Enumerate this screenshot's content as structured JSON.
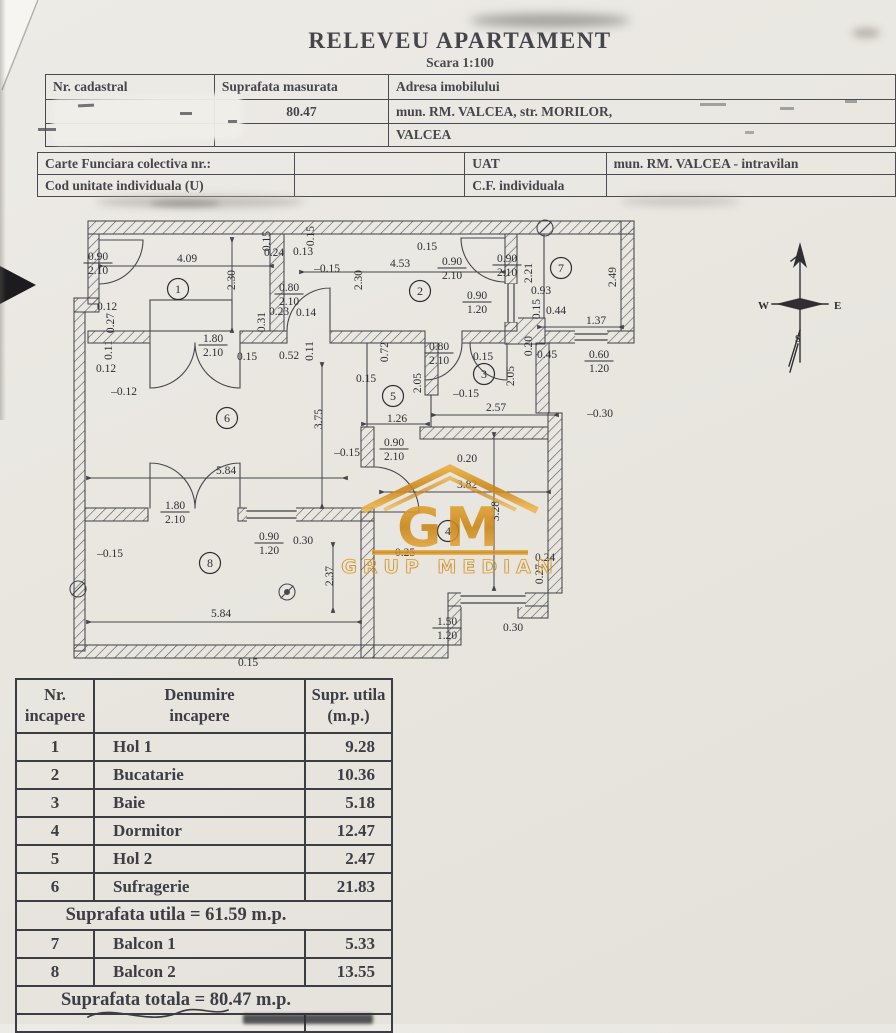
{
  "document": {
    "title": "RELEVEU APARTAMENT",
    "scale": "Scara 1:100"
  },
  "cadastral_table": {
    "col1_header": "Nr. cadastral",
    "col2_header": "Suprafata masurata",
    "col3_header": "Adresa imobilului",
    "measured_area": "80.47",
    "address_line1": "mun. RM. VALCEA, str. MORILOR,",
    "address_line2": "VALCEA"
  },
  "cf_table": {
    "row1_label": "Carte Funciara colectiva nr.:",
    "uat_label": "UAT",
    "uat_value": "mun. RM. VALCEA - intravilan",
    "row2_label": "Cod unitate individuala (U)",
    "cf_label": "C.F. individuala"
  },
  "plan": {
    "compass": {
      "west": "W",
      "east": "E",
      "south": "S"
    },
    "watermark": {
      "initials": "GM",
      "name": "GRUP MEDIAN",
      "color": "#d79a24"
    },
    "rooms": [
      {
        "n": "1",
        "x": 178,
        "y": 289
      },
      {
        "n": "2",
        "x": 420,
        "y": 291
      },
      {
        "n": "3",
        "x": 484,
        "y": 374
      },
      {
        "n": "4",
        "x": 448,
        "y": 531
      },
      {
        "n": "5",
        "x": 393,
        "y": 396
      },
      {
        "n": "6",
        "x": 227,
        "y": 418
      },
      {
        "n": "7",
        "x": 561,
        "y": 268
      },
      {
        "n": "8",
        "x": 210,
        "y": 563
      }
    ],
    "dims": [
      {
        "t": "4.09",
        "x": 187,
        "y": 258
      },
      {
        "f": [
          "0.90",
          "2.10"
        ],
        "x": 98,
        "y": 262
      },
      {
        "t": "2.30",
        "x": 231,
        "y": 280,
        "r": 1
      },
      {
        "t": "0.15",
        "x": 266,
        "y": 241,
        "r": 1
      },
      {
        "t": "0.24",
        "x": 274,
        "y": 252
      },
      {
        "t": "0.13",
        "x": 303,
        "y": 251
      },
      {
        "t": "0.15",
        "x": 310,
        "y": 236,
        "r": 1
      },
      {
        "t": "–0.15",
        "x": 327,
        "y": 268
      },
      {
        "f": [
          "0.80",
          "2.10"
        ],
        "x": 289,
        "y": 293
      },
      {
        "t": "0.23",
        "x": 279,
        "y": 311
      },
      {
        "t": "0.14",
        "x": 306,
        "y": 312
      },
      {
        "t": "0.31",
        "x": 261,
        "y": 322,
        "r": 1
      },
      {
        "t": "4.53",
        "x": 400,
        "y": 263
      },
      {
        "t": "0.15",
        "x": 427,
        "y": 246
      },
      {
        "t": "2.30",
        "x": 358,
        "y": 280,
        "r": 1
      },
      {
        "f": [
          "0.90",
          "2.10"
        ],
        "x": 452,
        "y": 267
      },
      {
        "f": [
          "0.90",
          "1.20"
        ],
        "x": 477,
        "y": 301
      },
      {
        "f": [
          "0.90",
          "2.10"
        ],
        "x": 507,
        "y": 264
      },
      {
        "t": "2.21",
        "x": 528,
        "y": 273,
        "r": 1
      },
      {
        "t": "0.93",
        "x": 541,
        "y": 290
      },
      {
        "t": "0.15",
        "x": 536,
        "y": 309,
        "r": 1
      },
      {
        "t": "0.44",
        "x": 556,
        "y": 310
      },
      {
        "t": "1.37",
        "x": 596,
        "y": 320
      },
      {
        "t": "2.49",
        "x": 612,
        "y": 277,
        "r": 1
      },
      {
        "t": "0.12",
        "x": 107,
        "y": 306
      },
      {
        "t": "0.27",
        "x": 110,
        "y": 323,
        "r": 1
      },
      {
        "t": "0.11",
        "x": 108,
        "y": 350,
        "r": 1
      },
      {
        "t": "0.12",
        "x": 106,
        "y": 368
      },
      {
        "t": "–0.12",
        "x": 124,
        "y": 391
      },
      {
        "f": [
          "1.80",
          "2.10"
        ],
        "x": 213,
        "y": 344
      },
      {
        "t": "0.15",
        "x": 247,
        "y": 356
      },
      {
        "t": "0.52",
        "x": 289,
        "y": 355
      },
      {
        "t": "0.11",
        "x": 309,
        "y": 351,
        "r": 1
      },
      {
        "t": "0.72",
        "x": 384,
        "y": 352,
        "r": 1
      },
      {
        "f": [
          "0.80",
          "2.10"
        ],
        "x": 439,
        "y": 352
      },
      {
        "t": "0.15",
        "x": 483,
        "y": 356
      },
      {
        "t": "0.15",
        "x": 366,
        "y": 378
      },
      {
        "t": "2.05",
        "x": 417,
        "y": 383,
        "r": 1
      },
      {
        "t": "2.05",
        "x": 510,
        "y": 376,
        "r": 1
      },
      {
        "t": "–0.15",
        "x": 466,
        "y": 393
      },
      {
        "t": "1.26",
        "x": 397,
        "y": 418
      },
      {
        "t": "2.57",
        "x": 496,
        "y": 407
      },
      {
        "t": "0.20",
        "x": 528,
        "y": 346,
        "r": 1
      },
      {
        "t": "0.45",
        "x": 547,
        "y": 354
      },
      {
        "f": [
          "0.60",
          "1.20"
        ],
        "x": 599,
        "y": 360
      },
      {
        "t": "–0.30",
        "x": 600,
        "y": 413
      },
      {
        "t": "3.75",
        "x": 318,
        "y": 419,
        "r": 1
      },
      {
        "t": "5.84",
        "x": 226,
        "y": 470
      },
      {
        "t": "–0.15",
        "x": 347,
        "y": 452
      },
      {
        "f": [
          "0.90",
          "2.10"
        ],
        "x": 394,
        "y": 448
      },
      {
        "t": "0.20",
        "x": 467,
        "y": 458
      },
      {
        "t": "3.82",
        "x": 467,
        "y": 484
      },
      {
        "f": [
          "1.80",
          "2.10"
        ],
        "x": 175,
        "y": 511
      },
      {
        "f": [
          "0.90",
          "1.20"
        ],
        "x": 269,
        "y": 542
      },
      {
        "t": "0.30",
        "x": 303,
        "y": 540
      },
      {
        "t": "2.37",
        "x": 329,
        "y": 576,
        "r": 1
      },
      {
        "t": "0.25",
        "x": 405,
        "y": 552
      },
      {
        "t": "3.28",
        "x": 495,
        "y": 511,
        "r": 1
      },
      {
        "t": "0.24",
        "x": 545,
        "y": 557
      },
      {
        "t": "0.27",
        "x": 539,
        "y": 574,
        "r": 1
      },
      {
        "t": "–0.15",
        "x": 110,
        "y": 553
      },
      {
        "t": "5.84",
        "x": 221,
        "y": 613
      },
      {
        "f": [
          "1.50",
          "1.20"
        ],
        "x": 447,
        "y": 627
      },
      {
        "t": "0.30",
        "x": 513,
        "y": 627
      },
      {
        "t": "0.15",
        "x": 248,
        "y": 662
      }
    ]
  },
  "rooms_table": {
    "headers": {
      "col1": [
        "Nr.",
        "incapere"
      ],
      "col2": [
        "Denumire",
        "incapere"
      ],
      "col3": [
        "Supr. utila",
        "(m.p.)"
      ]
    },
    "rows": [
      {
        "nr": "1",
        "name": "Hol 1",
        "area": "9.28"
      },
      {
        "nr": "2",
        "name": "Bucatarie",
        "area": "10.36"
      },
      {
        "nr": "3",
        "name": "Baie",
        "area": "5.18"
      },
      {
        "nr": "4",
        "name": "Dormitor",
        "area": "12.47"
      },
      {
        "nr": "5",
        "name": "Hol 2",
        "area": "2.47"
      },
      {
        "nr": "6",
        "name": "Sufragerie",
        "area": "21.83"
      }
    ],
    "subtotal": "Suprafata utila = 61.59 m.p.",
    "balcony_rows": [
      {
        "nr": "7",
        "name": "Balcon 1",
        "area": "5.33"
      },
      {
        "nr": "8",
        "name": "Balcon 2",
        "area": "13.55"
      }
    ],
    "total": "Suprafata totala = 80.47 m.p."
  }
}
